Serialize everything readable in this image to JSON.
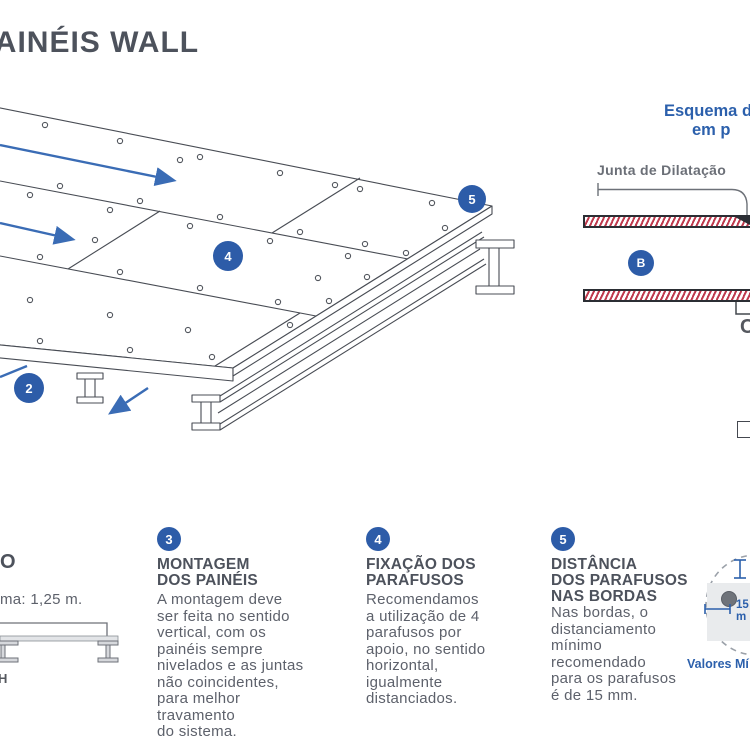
{
  "title": "PAINÉIS WALL",
  "diagram": {
    "callout_2": "2",
    "callout_4": "4",
    "callout_5": "5"
  },
  "plan": {
    "heading_line1": "Esquema d",
    "heading_line2": "em p",
    "joint_label": "Junta de Dilatação",
    "callout_b": "B",
    "edge_letter_fragment": "C"
  },
  "columns": {
    "col1": {
      "heading_fragment": "O",
      "body_fragment": "ma: 1,25 m.",
      "beam_label_fragment": "H"
    },
    "col3": {
      "number": "3",
      "heading_lines": [
        "MONTAGEM",
        "DOS PAINÉIS"
      ],
      "body_lines": [
        "A montagem deve",
        "ser feita no sentido",
        "vertical, com os",
        "painéis sempre",
        "nivelados e as juntas",
        "não coincidentes,",
        "para melhor",
        "travamento",
        "do sistema."
      ]
    },
    "col4": {
      "number": "4",
      "heading_lines": [
        "FIXAÇÃO DOS",
        "PARAFUSOS"
      ],
      "body_lines": [
        "Recomendamos",
        "a utilização de 4",
        "parafusos por",
        "apoio, no sentido",
        "horizontal,",
        "igualmente",
        "distanciados."
      ]
    },
    "col5": {
      "number": "5",
      "heading_lines": [
        "DISTÂNCIA",
        "DOS PARAFUSOS",
        "NAS BORDAS"
      ],
      "body_lines": [
        "Nas bordas, o",
        "distanciamento",
        "mínimo",
        "recomendado",
        "para os parafusos",
        "é de 15 mm."
      ],
      "detail": {
        "dim_line1": "15 m",
        "dim_line2": "m",
        "caption_fragment": "Valores Mí"
      }
    }
  },
  "colors": {
    "accent_blue": "#2d5ca8",
    "arrow_blue": "#3a6cb5",
    "heading_gray": "#4d525c",
    "body_gray": "#5d616b",
    "hatch_red": "#bf3a4e"
  }
}
